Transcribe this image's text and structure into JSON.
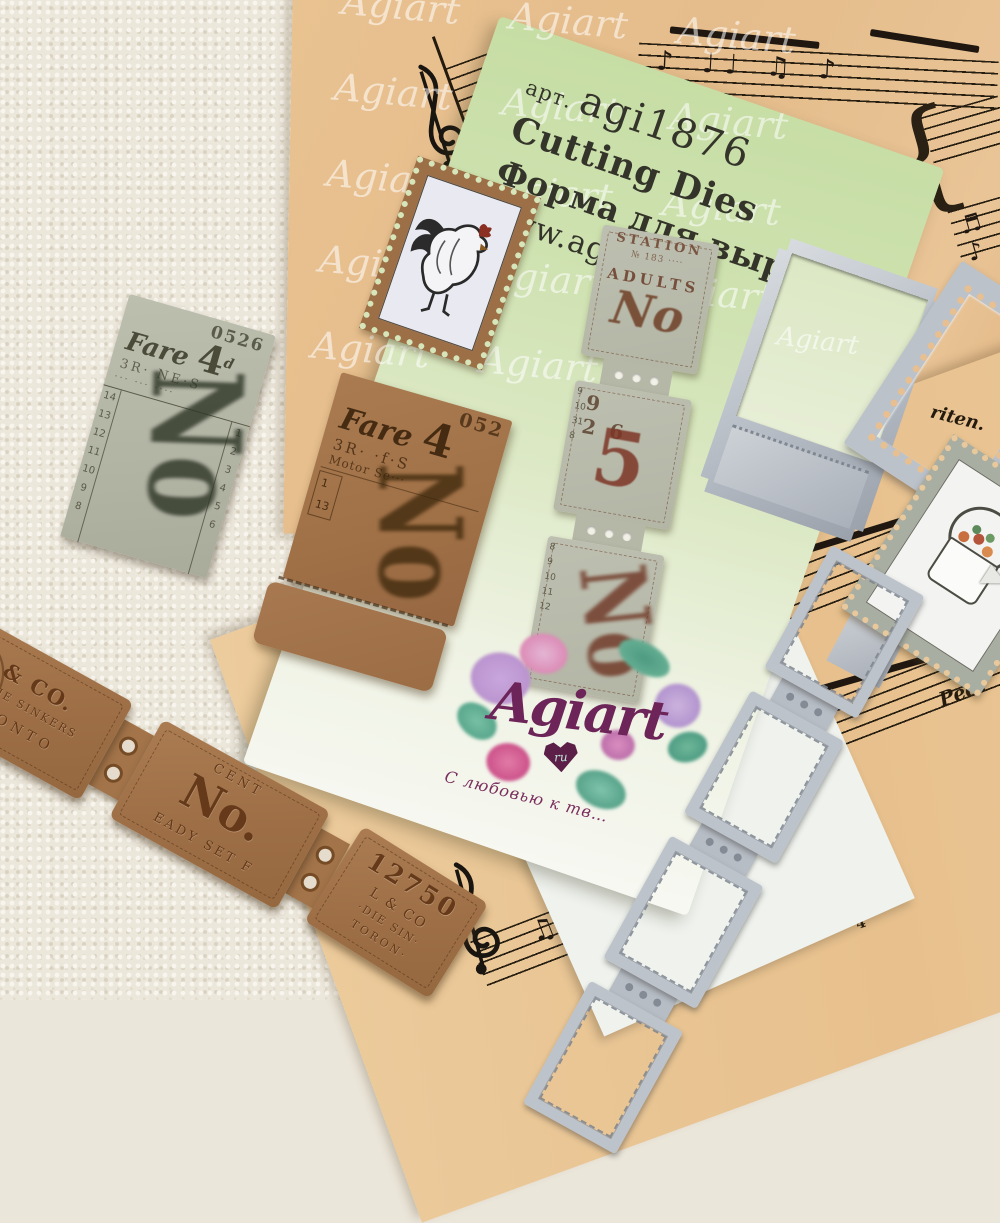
{
  "card": {
    "art_label": "арт.",
    "art_code": "agi1876",
    "product_type_en": "Cutting Dies",
    "product_type_ru": "Форма для вырубки",
    "website": "www.agiart.ru",
    "watermark_word": "Agiart"
  },
  "logo": {
    "brand": "Agiart",
    "heart_text": "ru",
    "tagline": "С любовью к тв…"
  },
  "grey_ticket": {
    "serial": "0526",
    "fare_label": "Fare",
    "fare_value": "4",
    "fare_sup": "d",
    "line1": "3R· NE·S",
    "line2": "··· ··· ····",
    "left_numbers": "14\n13\n12\n11\n10\n9\n8",
    "right_numbers": "1\n2\n3\n4\n5\n6",
    "overprint": "No"
  },
  "kraft_ticket": {
    "serial": "052",
    "fare_label": "Fare",
    "fare_value": "4",
    "line1": "3R· ·f·S",
    "line2": "Motor Se···",
    "row_numbers": "1\n13",
    "overprint": "No"
  },
  "ticket_strip": {
    "seg1": {
      "arc_text": "STATION",
      "line1": "№ 183 ····",
      "word": "ADULTS",
      "overprint": "No"
    },
    "seg2": {
      "row": "9 26",
      "big_digit": "5",
      "edge_numbers": "9\n10\n31\n8"
    },
    "seg3": {
      "overprint": "No",
      "edge_numbers": "8\n9\n10\n11\n12"
    }
  },
  "kraft_chain": {
    "seg1": {
      "line1": "L & CO.",
      "line2": "ROD·DIE SINKERS",
      "line3": "TORONTO"
    },
    "seg2": {
      "line1": "CENT",
      "big": "No.",
      "line2": "EADY SET F"
    },
    "seg3": {
      "serial": "12750",
      "line1": "L & CO",
      "line2": "·DIE SIN·",
      "line3": "TORON·"
    }
  },
  "music": {
    "riten": "riten.",
    "ped": "Ped.",
    "finger_top": "5",
    "finger_mid": "3",
    "finger_right": "4",
    "row_top": "♪ ♩♩  ♫   ♪",
    "row_mid": "♬ ♪",
    "row_b1": "♩  ♫  ♪♪  ♩",
    "row_b2": "♪ ♩  ♬  ♫ ♪",
    "row_b3": "♫  ♪ ♩"
  }
}
